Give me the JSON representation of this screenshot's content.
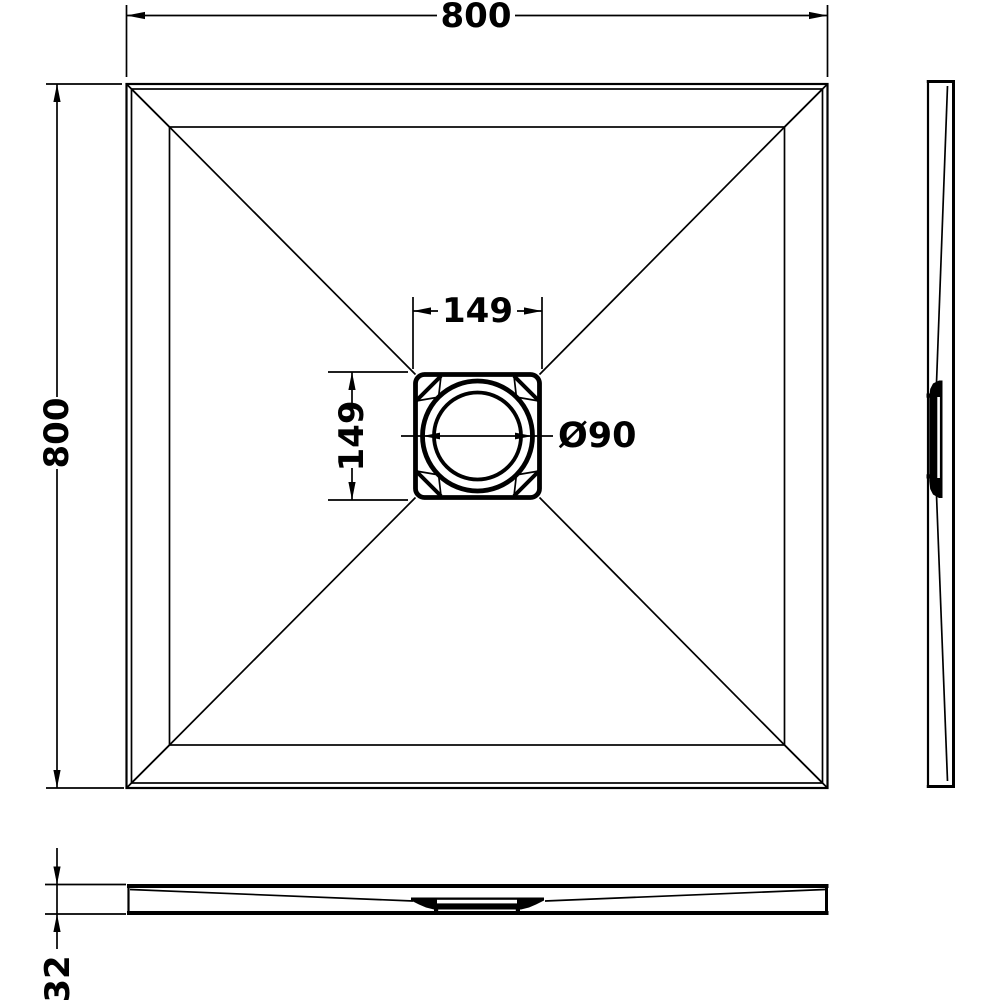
{
  "colors": {
    "line": "#000000",
    "background": "#ffffff"
  },
  "dimensions": {
    "overall_width": {
      "label": "800",
      "orientation": "horizontal"
    },
    "overall_depth": {
      "label": "800",
      "orientation": "vertical"
    },
    "drain_box_width": {
      "label": "149",
      "orientation": "horizontal"
    },
    "drain_box_height": {
      "label": "149",
      "orientation": "vertical"
    },
    "waste_diameter": {
      "label": "Ø90",
      "orientation": "horizontal"
    },
    "tray_thickness": {
      "label": "32",
      "orientation": "vertical"
    }
  }
}
